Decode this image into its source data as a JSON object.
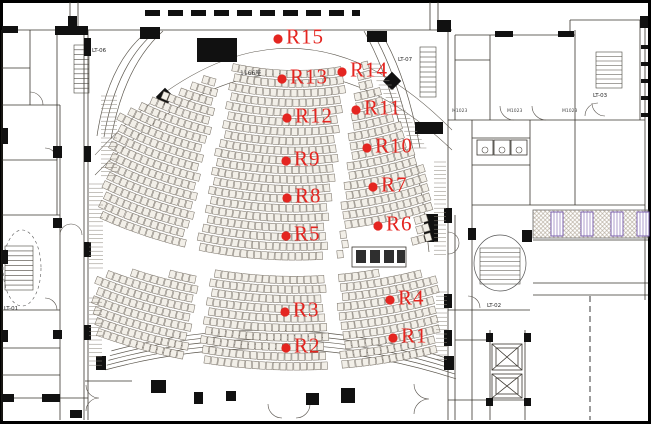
{
  "plan": {
    "seat_count_label": "1166座",
    "colors": {
      "point": "#e42520",
      "purple": "#7a5fae"
    },
    "measurement_points": [
      {
        "id": "R1",
        "x": 393,
        "y": 338
      },
      {
        "id": "R2",
        "x": 286,
        "y": 348
      },
      {
        "id": "R3",
        "x": 285,
        "y": 312
      },
      {
        "id": "R4",
        "x": 390,
        "y": 300
      },
      {
        "id": "R5",
        "x": 286,
        "y": 236
      },
      {
        "id": "R6",
        "x": 378,
        "y": 226
      },
      {
        "id": "R7",
        "x": 373,
        "y": 187
      },
      {
        "id": "R8",
        "x": 287,
        "y": 198
      },
      {
        "id": "R9",
        "x": 286,
        "y": 161
      },
      {
        "id": "R10",
        "x": 367,
        "y": 148
      },
      {
        "id": "R11",
        "x": 356,
        "y": 110
      },
      {
        "id": "R12",
        "x": 287,
        "y": 118
      },
      {
        "id": "R13",
        "x": 282,
        "y": 79
      },
      {
        "id": "R14",
        "x": 342,
        "y": 72
      },
      {
        "id": "R15",
        "x": 278,
        "y": 39
      }
    ],
    "stair_labels": [
      {
        "text": "LT-01",
        "x": 4,
        "y": 310
      },
      {
        "text": "LT-02",
        "x": 487,
        "y": 307
      },
      {
        "text": "LT-03",
        "x": 593,
        "y": 97
      },
      {
        "text": "LT-06",
        "x": 92,
        "y": 52
      },
      {
        "text": "LT-07",
        "x": 398,
        "y": 61
      }
    ],
    "door_labels": [
      {
        "text": "M1023",
        "x": 452,
        "y": 112
      },
      {
        "text": "M1023",
        "x": 507,
        "y": 112
      },
      {
        "text": "M1023",
        "x": 562,
        "y": 112
      }
    ]
  }
}
